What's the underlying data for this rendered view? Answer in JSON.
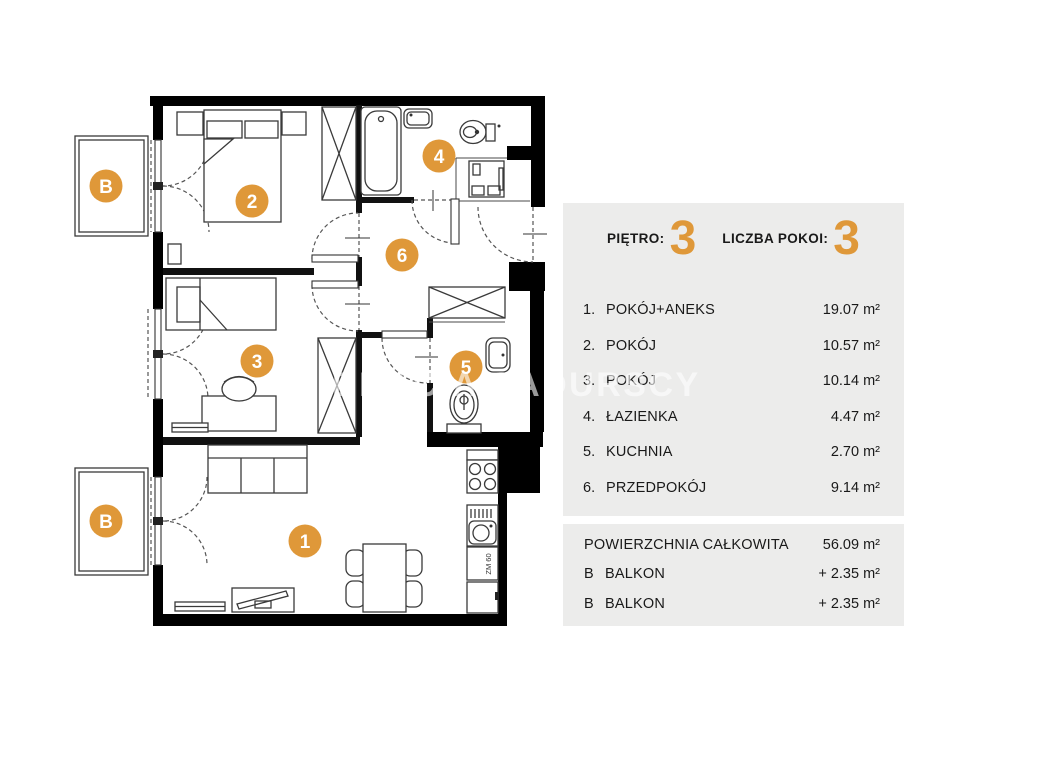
{
  "colors": {
    "accent": "#DF9839",
    "panel_bg": "#ECECEB",
    "watermark": "rgba(255,255,255,0.6)"
  },
  "watermark": "BRACIA SADURSCY",
  "floorplan": {
    "circles": [
      {
        "name": "balcony-top",
        "label": "B"
      },
      {
        "name": "room-2",
        "label": "2"
      },
      {
        "name": "room-4",
        "label": "4"
      },
      {
        "name": "room-6",
        "label": "6"
      },
      {
        "name": "room-3",
        "label": "3"
      },
      {
        "name": "room-5",
        "label": "5"
      },
      {
        "name": "balcony-bottom",
        "label": "B"
      },
      {
        "name": "room-1",
        "label": "1"
      }
    ],
    "annex_label": "ZM 60"
  },
  "panel": {
    "floor_label": "PIĘTRO:",
    "floor_value": "3",
    "rooms_label": "LICZBA POKOI:",
    "rooms_value": "3",
    "rows": [
      {
        "num": "1.",
        "name": "POKÓJ+ANEKS",
        "area": "19.07 m²"
      },
      {
        "num": "2.",
        "name": "POKÓJ",
        "area": "10.57 m²"
      },
      {
        "num": "3.",
        "name": "POKÓJ",
        "area": "10.14 m²"
      },
      {
        "num": "4.",
        "name": "ŁAZIENKA",
        "area": "4.47 m²"
      },
      {
        "num": "5.",
        "name": "KUCHNIA",
        "area": "2.70 m²"
      },
      {
        "num": "6.",
        "name": "PRZEDPOKÓJ",
        "area": "9.14 m²"
      }
    ],
    "summary_total": {
      "name": "POWIERZCHNIA CAŁKOWITA",
      "area": "56.09 m²"
    },
    "summary_rows": [
      {
        "num": "B",
        "name": "BALKON",
        "area": "+  2.35 m²"
      },
      {
        "num": "B",
        "name": "BALKON",
        "area": "+  2.35 m²"
      }
    ]
  }
}
